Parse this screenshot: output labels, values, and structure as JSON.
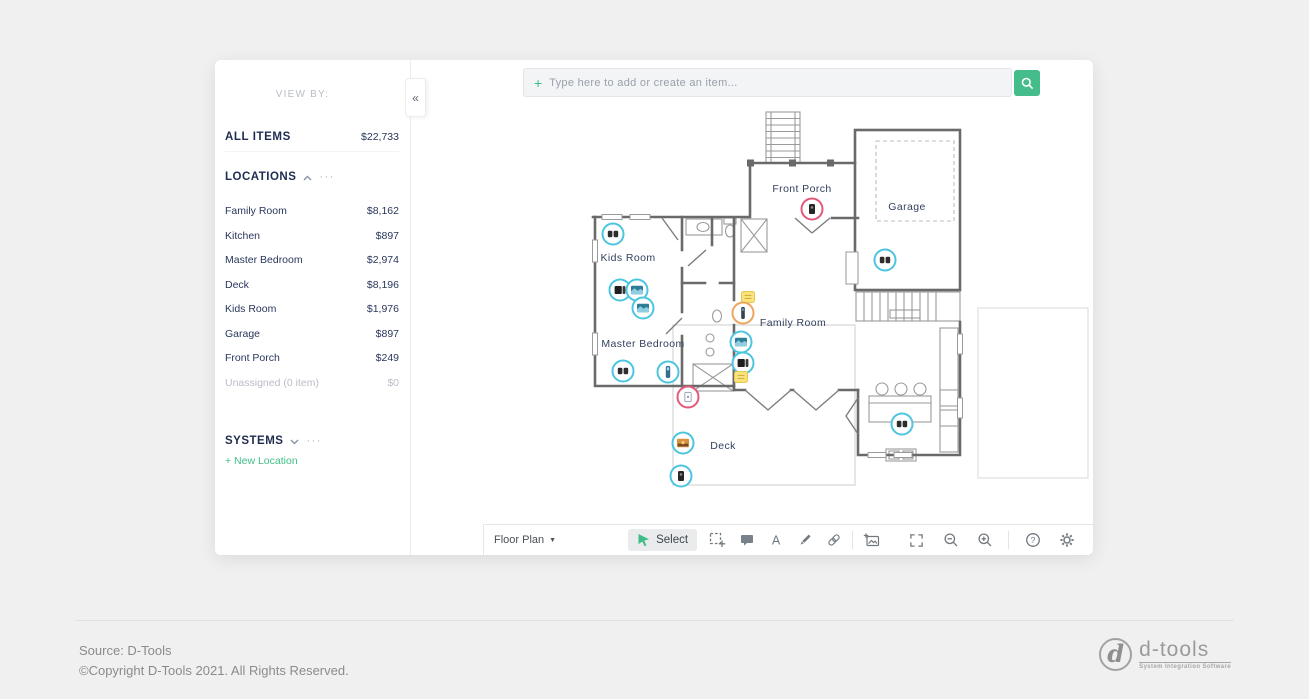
{
  "sidebar": {
    "view_by": "VIEW BY:",
    "collapse_icon": "«",
    "menu_dots": "···",
    "all_items": {
      "label": "ALL ITEMS",
      "value": "$22,733"
    },
    "locations": {
      "header": "LOCATIONS",
      "items": [
        {
          "name": "Family Room",
          "value": "$8,162"
        },
        {
          "name": "Kitchen",
          "value": "$897"
        },
        {
          "name": "Master Bedroom",
          "value": "$2,974"
        },
        {
          "name": "Deck",
          "value": "$8,196"
        },
        {
          "name": "Kids Room",
          "value": "$1,976"
        },
        {
          "name": "Garage",
          "value": "$897"
        },
        {
          "name": "Front Porch",
          "value": "$249"
        },
        {
          "name": "Unassigned (0 item)",
          "value": "$0"
        }
      ],
      "new_location": "+ New Location"
    },
    "systems": {
      "header": "SYSTEMS"
    }
  },
  "search": {
    "plus": "+",
    "placeholder": "Type here to add or create an item..."
  },
  "toolbar": {
    "view_selector": "Floor Plan",
    "caret": "▼",
    "select_label": "Select",
    "text_tool_glyph": "A",
    "help_glyph": "?"
  },
  "floorplan": {
    "labels": [
      "Front Porch",
      "Garage",
      "Kids Room",
      "Master Bedroom",
      "Family Room",
      "Deck"
    ],
    "colors": {
      "cyan": "#4cc5e0",
      "orange": "#eda55e",
      "pink": "#e2597a"
    },
    "markers": [
      {
        "x": 613,
        "y": 234,
        "ring": "cyan",
        "glyph": "speakers"
      },
      {
        "x": 620,
        "y": 290,
        "ring": "cyan",
        "glyph": "device"
      },
      {
        "x": 637,
        "y": 290,
        "ring": "cyan",
        "glyph": "tv"
      },
      {
        "x": 643,
        "y": 308,
        "ring": "cyan",
        "glyph": "tv"
      },
      {
        "x": 623,
        "y": 371,
        "ring": "cyan",
        "glyph": "speakers"
      },
      {
        "x": 668,
        "y": 372,
        "ring": "cyan",
        "glyph": "tower"
      },
      {
        "x": 748,
        "y": 297,
        "ring": "none",
        "glyph": "note"
      },
      {
        "x": 743,
        "y": 313,
        "ring": "orange",
        "glyph": "tower_dark"
      },
      {
        "x": 741,
        "y": 342,
        "ring": "cyan",
        "glyph": "tv"
      },
      {
        "x": 743,
        "y": 363,
        "ring": "cyan",
        "glyph": "device"
      },
      {
        "x": 741,
        "y": 377,
        "ring": "none",
        "glyph": "note"
      },
      {
        "x": 812,
        "y": 209,
        "ring": "pink",
        "glyph": "doorbell"
      },
      {
        "x": 688,
        "y": 397,
        "ring": "pink",
        "glyph": "keypad"
      },
      {
        "x": 683,
        "y": 443,
        "ring": "cyan",
        "glyph": "tv_sunset"
      },
      {
        "x": 681,
        "y": 476,
        "ring": "cyan",
        "glyph": "doorbell"
      },
      {
        "x": 885,
        "y": 260,
        "ring": "cyan",
        "glyph": "speakers"
      },
      {
        "x": 902,
        "y": 424,
        "ring": "cyan",
        "glyph": "speakers"
      }
    ]
  },
  "footer": {
    "source": "Source: D-Tools",
    "copyright": "©Copyright D-Tools 2021. All Rights Reserved.",
    "logo_d": "d",
    "logo_text": "d-tools",
    "logo_tagline": "System Integration Software"
  }
}
